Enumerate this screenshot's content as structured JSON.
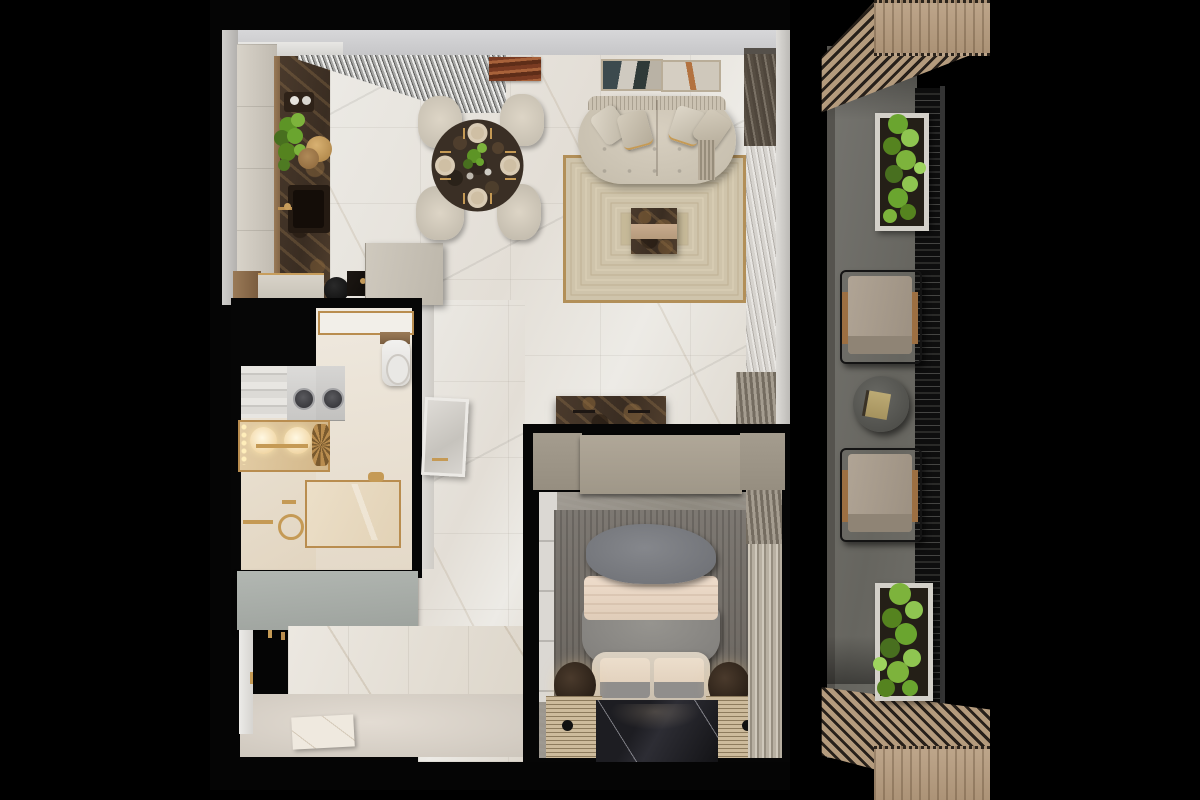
{
  "meta": {
    "title": "3D top-down apartment floor plan render with balcony",
    "view": "top-down",
    "canvas": {
      "width": 1200,
      "height": 800
    },
    "background": "#000000"
  },
  "palette": {
    "black": "#000000",
    "wall": "#cdcdcf",
    "marble": "#ebe8e3",
    "cream": "#d2c9ba",
    "gold": "#b98d4f",
    "wood": "#8a6b4c",
    "brownm": "#42352a",
    "rug": "#cfc4ab",
    "rugline": "#a89370",
    "taupe": "#a59d8f",
    "concrete": "#98938c",
    "bedrug": "#767169",
    "bedgray": "#8d8b89",
    "pillow": "#7b7d81",
    "blanket": "#e8d6c5",
    "blackm": "#17171a",
    "ribbed": "#c9b89b",
    "sage": "#a9afab",
    "balfloor": "#6f6e6a",
    "pergola": "#b49b7d",
    "leaf": "#7db33c",
    "planter": "#d3d0c9",
    "ochair": "#a89c8c",
    "otable": "#55554f",
    "sheer": "#d9d6d1"
  },
  "apartment": {
    "rooms": [
      {
        "name": "kitchen-dining",
        "items": [
          "upper-cabinet-beam",
          "cabinet-column",
          "dark-marble-counter",
          "kitchen-sink",
          "gold-faucet",
          "herb-plant",
          "serving-tray",
          "island-counter",
          "round-basin",
          "cooktop",
          "tall-cabinet",
          "louver-canopy",
          "round-dining-table",
          "place-settings x4",
          "dining-chairs x4"
        ]
      },
      {
        "name": "living-room",
        "items": [
          "curved-sofa",
          "throw-pillows x4",
          "fringed-throw",
          "wall-art x3",
          "area-rug",
          "marble-ottoman",
          "media-console",
          "sheer-curtains",
          "curtain-bunches x2"
        ]
      },
      {
        "name": "bathroom",
        "items": [
          "shower-niche",
          "wood-shelf",
          "toilet",
          "washer",
          "dryer",
          "linen-shelf",
          "vanity-lights",
          "twin-basins",
          "gold-ornament",
          "walk-in-shower",
          "gold-fixtures",
          "towel-bar"
        ]
      },
      {
        "name": "entry-hall",
        "items": [
          "sage-wardrobe",
          "entry-door",
          "door-hooks",
          "marble-wainscot",
          "doormat",
          "leaning-mirror"
        ]
      },
      {
        "name": "bedroom",
        "items": [
          "taupe-wardrobe",
          "closet-strip",
          "bed",
          "gray-pillow-mass",
          "beige-blanket",
          "gray-duvet",
          "headboard-bench",
          "bench-cushions x2",
          "nightstand-lamps x2",
          "ribbed-benches x2",
          "black-marble-runner",
          "bedroom-rug",
          "bedroom-curtains"
        ]
      }
    ]
  },
  "balcony": {
    "items": [
      "pergola-canopy-top",
      "pergola-deck-top",
      "pergola-canopy-bottom",
      "pergola-deck-bottom",
      "planter-top",
      "planter-bottom",
      "lounge-chair x2",
      "round-side-table",
      "book",
      "railing",
      "handrail",
      "concrete-floor"
    ]
  }
}
